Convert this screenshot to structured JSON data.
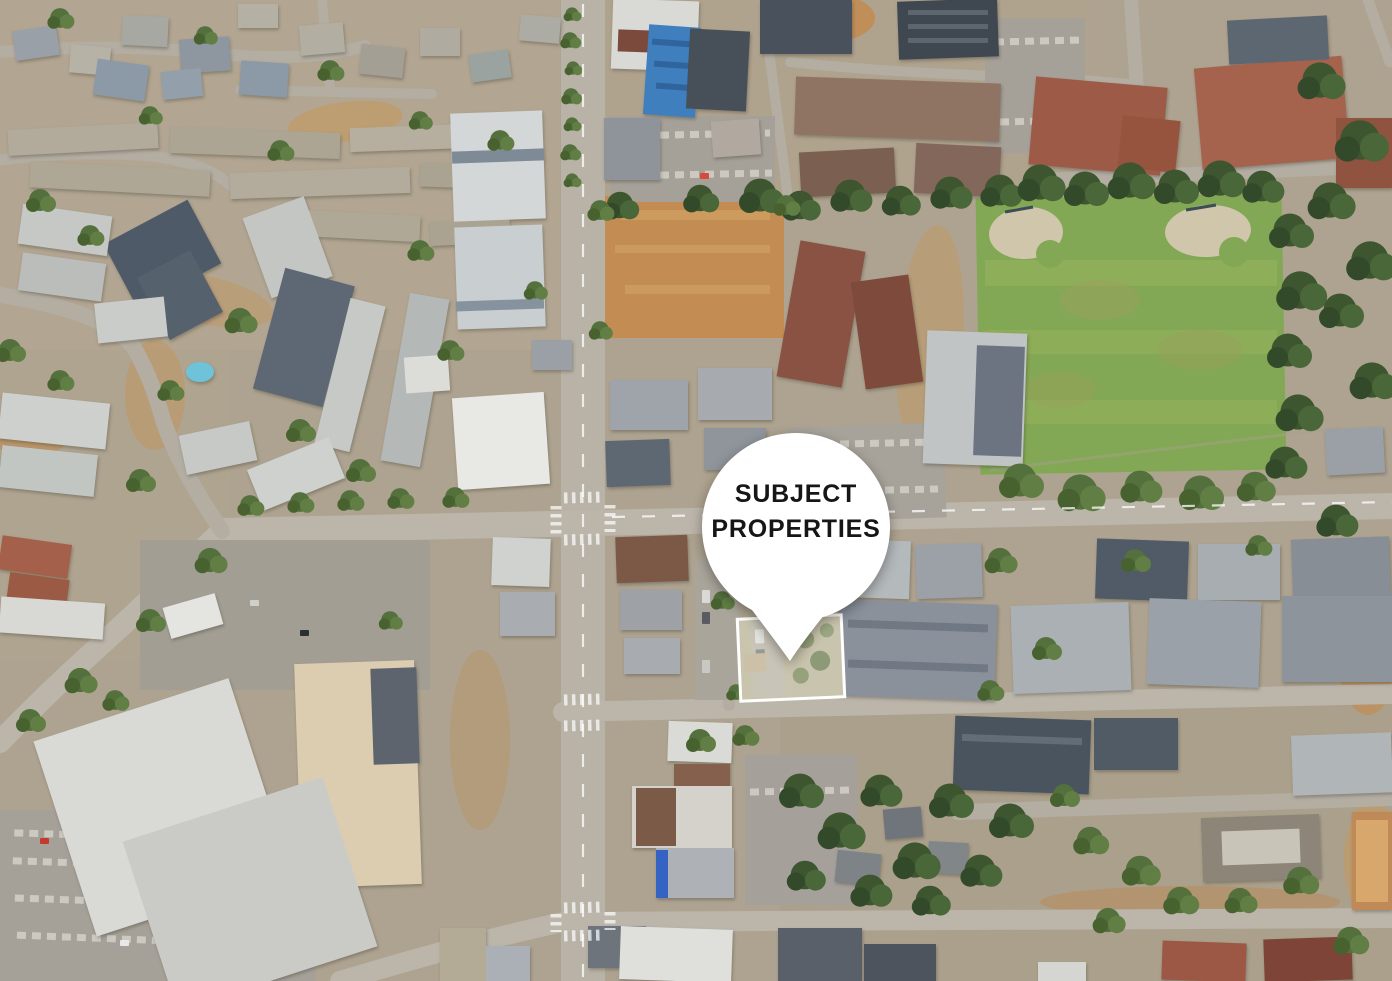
{
  "marker": {
    "line1": "SUBJECT",
    "line2": "PROPERTIES"
  },
  "colors": {
    "marker_fill": "#ffffff",
    "marker_text": "#161616",
    "parcel_outline": "#ffffff"
  }
}
